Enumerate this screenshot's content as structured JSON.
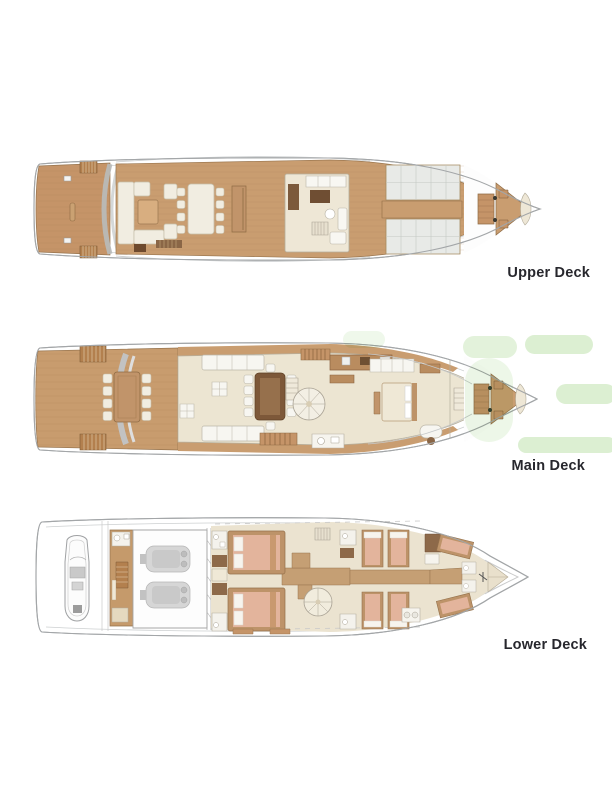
{
  "title": "Yacht deck plans",
  "decks": [
    {
      "id": "upper",
      "label": "Upper Deck"
    },
    {
      "id": "main",
      "label": "Main Deck"
    },
    {
      "id": "lower",
      "label": "Lower Deck"
    }
  ],
  "colors": {
    "background": "#ffffff",
    "teak": "#c89c6e",
    "teak_dark": "#8f6b44",
    "interior_cream": "#ece5d2",
    "furniture_white": "#f7f6f1",
    "wood_dark": "#7d5839",
    "bed_salmon": "#e3b49c",
    "bed_frame": "#bd9369",
    "skylight_gray": "#e8eae7",
    "engine_gray": "#d6d6d6",
    "hull_outline": "#a3a6a8",
    "watermark_green": "#dcefd2",
    "label_text": "#27272d"
  }
}
